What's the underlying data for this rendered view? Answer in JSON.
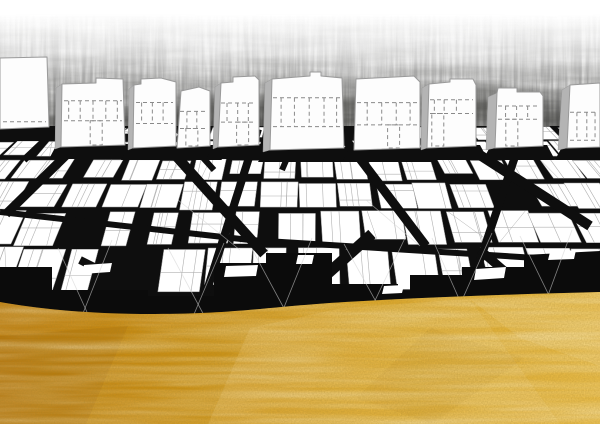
{
  "canvas": {
    "width": 600,
    "height": 424
  },
  "colors": {
    "paper": "#ffffff",
    "map_black": "#0e0e0e",
    "band_black": "#0b0b0b",
    "block_white": "#ffffff",
    "block_stroke": "#979797",
    "parcel_line": "#b0b0b0",
    "building_fill": "#fdfdfd",
    "building_stroke": "#9a9a9a",
    "building_side": "#b4b4b4",
    "dash_line": "#8a8a8a",
    "ray": "#d2d2d2",
    "charcoal": "#2e2e2c",
    "charcoal_wash": "#9b9b98",
    "gold_dark": "#bf7e0e",
    "gold_light": "#eabd4a"
  },
  "charcoal": {
    "band_top": 14,
    "band_height": 136,
    "blotches": [
      [
        255,
        116,
        115,
        22,
        0.55
      ],
      [
        470,
        104,
        75,
        20,
        0.5
      ],
      [
        120,
        124,
        85,
        15,
        0.35
      ],
      [
        340,
        96,
        60,
        16,
        0.4
      ],
      [
        560,
        120,
        60,
        16,
        0.45
      ]
    ]
  },
  "buildings": [
    {
      "front": [
        [
          0,
          58
        ],
        [
          47,
          57
        ],
        [
          49,
          127
        ],
        [
          0,
          129
        ]
      ],
      "levels": [
        0.9
      ],
      "mullions": [],
      "door": null
    },
    {
      "front": [
        [
          62,
          84
        ],
        [
          96,
          83
        ],
        [
          96,
          78
        ],
        [
          123,
          79
        ],
        [
          125,
          145
        ],
        [
          61,
          147
        ]
      ],
      "side": [
        [
          56,
          88
        ],
        [
          62,
          84
        ],
        [
          61,
          147
        ],
        [
          55,
          149
        ]
      ],
      "levels": [
        0.33,
        0.62
      ],
      "mullions": [
        0.12,
        0.3,
        0.5,
        0.7,
        0.88
      ],
      "door": 0.55
    },
    {
      "front": [
        [
          134,
          85
        ],
        [
          141,
          84
        ],
        [
          141,
          79
        ],
        [
          161,
          78
        ],
        [
          176,
          82
        ],
        [
          176,
          146
        ],
        [
          133,
          148
        ]
      ],
      "side": [
        [
          129,
          89
        ],
        [
          134,
          85
        ],
        [
          133,
          148
        ],
        [
          128,
          150
        ]
      ],
      "levels": [
        0.35,
        0.65
      ],
      "mullions": [
        0.2,
        0.45,
        0.7
      ],
      "door": null
    },
    {
      "front": [
        [
          181,
          91
        ],
        [
          199,
          87
        ],
        [
          210,
          91
        ],
        [
          210,
          146
        ],
        [
          177,
          148
        ]
      ],
      "levels": [
        0.4,
        0.68
      ],
      "mullions": [
        0.3,
        0.6
      ],
      "door": 0.45
    },
    {
      "front": [
        [
          221,
          83
        ],
        [
          233,
          82
        ],
        [
          233,
          77
        ],
        [
          255,
          76
        ],
        [
          259,
          80
        ],
        [
          259,
          145
        ],
        [
          218,
          147
        ]
      ],
      "side": [
        [
          215,
          87
        ],
        [
          221,
          83
        ],
        [
          218,
          147
        ],
        [
          213,
          149
        ]
      ],
      "levels": [
        0.38,
        0.65
      ],
      "mullions": [
        0.22,
        0.48,
        0.74
      ],
      "door": 0.6
    },
    {
      "front": [
        [
          272,
          79
        ],
        [
          310,
          76
        ],
        [
          310,
          72
        ],
        [
          321,
          72
        ],
        [
          321,
          76
        ],
        [
          342,
          78
        ],
        [
          344,
          148
        ],
        [
          270,
          150
        ]
      ],
      "side": [
        [
          265,
          83
        ],
        [
          272,
          79
        ],
        [
          270,
          150
        ],
        [
          263,
          152
        ]
      ],
      "levels": [
        0.33,
        0.7
      ],
      "mullions": [
        0.15,
        0.33,
        0.53,
        0.73,
        0.9
      ],
      "door": null
    },
    {
      "front": [
        [
          356,
          79
        ],
        [
          414,
          76
        ],
        [
          420,
          82
        ],
        [
          420,
          148
        ],
        [
          354,
          150
        ]
      ],
      "levels": [
        0.36,
        0.66
      ],
      "mullions": [
        0.2,
        0.42,
        0.64,
        0.85
      ],
      "door": 0.6
    },
    {
      "front": [
        [
          429,
          84
        ],
        [
          450,
          82
        ],
        [
          450,
          79
        ],
        [
          473,
          79
        ],
        [
          476,
          85
        ],
        [
          476,
          146
        ],
        [
          427,
          148
        ]
      ],
      "side": [
        [
          422,
          88
        ],
        [
          429,
          84
        ],
        [
          427,
          148
        ],
        [
          421,
          150
        ]
      ],
      "levels": [
        0.3,
        0.5
      ],
      "mullions": [
        0.15,
        0.35,
        0.6
      ],
      "door": 0.22
    },
    {
      "front": [
        [
          497,
          93
        ],
        [
          498,
          88
        ],
        [
          517,
          88
        ],
        [
          517,
          92
        ],
        [
          540,
          92
        ],
        [
          543,
          96
        ],
        [
          543,
          146
        ],
        [
          495,
          148
        ]
      ],
      "side": [
        [
          488,
          97
        ],
        [
          497,
          93
        ],
        [
          495,
          148
        ],
        [
          486,
          150
        ]
      ],
      "levels": [
        0.3,
        0.52
      ],
      "mullions": [
        0.22,
        0.45,
        0.68
      ],
      "door": 0.35
    },
    {
      "front": [
        [
          570,
          85
        ],
        [
          600,
          83
        ],
        [
          600,
          147
        ],
        [
          567,
          148
        ]
      ],
      "side": [
        [
          562,
          90
        ],
        [
          570,
          85
        ],
        [
          567,
          148
        ],
        [
          558,
          150
        ]
      ],
      "levels": [
        0.45,
        0.88
      ],
      "mullions": [
        0.3,
        0.6,
        0.85
      ],
      "door": null
    }
  ],
  "map": {
    "top": 126,
    "height": 178,
    "seed": 13,
    "skip": 0.06,
    "rows": [
      {
        "y": 128,
        "h": 14,
        "w": 30
      },
      {
        "y": 142,
        "h": 18,
        "w": 33
      },
      {
        "y": 160,
        "h": 23,
        "w": 36
      },
      {
        "y": 183,
        "h": 29,
        "w": 40
      },
      {
        "y": 212,
        "h": 36,
        "w": 44
      },
      {
        "y": 248,
        "h": 46,
        "w": 48
      }
    ],
    "streets": [
      [
        96,
        126,
        6,
        214,
        9
      ],
      [
        150,
        127,
        264,
        254,
        10
      ],
      [
        258,
        129,
        204,
        300,
        8
      ],
      [
        336,
        127,
        426,
        246,
        9
      ],
      [
        438,
        128,
        590,
        226,
        10
      ],
      [
        524,
        130,
        466,
        302,
        8
      ],
      [
        176,
        128,
        214,
        170,
        6
      ],
      [
        300,
        128,
        282,
        170,
        6
      ],
      [
        0,
        212,
        250,
        240,
        6
      ],
      [
        250,
        240,
        600,
        262,
        6
      ],
      [
        372,
        234,
        296,
        302,
        11
      ],
      [
        80,
        260,
        160,
        300,
        8
      ],
      [
        480,
        250,
        540,
        302,
        9
      ],
      [
        60,
        126,
        24,
        160,
        7
      ]
    ]
  },
  "band": {
    "path": "M0,267 L52,267 L52,290 L148,290 L148,296 L214,296 L214,263 L266,263 L266,253 L332,253 L332,284 L398,284 L398,291 L410,291 L410,275 L462,275 L462,267 L524,267 L524,255 L600,251 L600,318 L0,330 Z",
    "shards": [
      [
        [
          226,
          266
        ],
        [
          258,
          265
        ],
        [
          256,
          276
        ],
        [
          224,
          277
        ]
      ],
      [
        [
          298,
          255
        ],
        [
          314,
          255
        ],
        [
          312,
          264
        ],
        [
          296,
          264
        ]
      ],
      [
        [
          476,
          269
        ],
        [
          506,
          267
        ],
        [
          504,
          278
        ],
        [
          474,
          280
        ]
      ],
      [
        [
          84,
          265
        ],
        [
          112,
          263
        ],
        [
          110,
          272
        ],
        [
          82,
          274
        ]
      ],
      [
        [
          550,
          252
        ],
        [
          576,
          250
        ],
        [
          574,
          259
        ],
        [
          548,
          260
        ]
      ],
      [
        [
          384,
          286
        ],
        [
          404,
          285
        ],
        [
          402,
          293
        ],
        [
          382,
          294
        ]
      ]
    ]
  },
  "rays": [
    [
      58,
      248,
      96,
      332
    ],
    [
      112,
      240,
      74,
      336
    ],
    [
      168,
      248,
      214,
      334
    ],
    [
      224,
      243,
      184,
      338
    ],
    [
      252,
      249,
      300,
      338
    ],
    [
      312,
      238,
      270,
      342
    ],
    [
      344,
      244,
      394,
      334
    ],
    [
      406,
      236,
      356,
      340
    ],
    [
      432,
      238,
      472,
      328
    ],
    [
      492,
      233,
      446,
      336
    ],
    [
      520,
      236,
      562,
      322
    ],
    [
      572,
      230,
      536,
      328
    ],
    [
      178,
      200,
      240,
      250
    ],
    [
      366,
      200,
      420,
      246
    ]
  ],
  "gold": {
    "edge_path": "M0,302 C45,310 95,314 155,314 C235,314 265,307 345,302 C432,297 520,294 600,292 L600,424 L0,424 Z",
    "gradient": [
      {
        "offset": 0,
        "color": "#bf7e0e"
      },
      {
        "offset": 0.35,
        "color": "#cf9418"
      },
      {
        "offset": 0.6,
        "color": "#dda82b"
      },
      {
        "offset": 1,
        "color": "#eabd4a"
      }
    ],
    "facets": [
      {
        "points": [
          [
            250,
            328
          ],
          [
            342,
            308
          ],
          [
            302,
            424
          ],
          [
            208,
            424
          ]
        ],
        "fill": "#ffe9a8",
        "opacity": 0.16
      },
      {
        "points": [
          [
            342,
            308
          ],
          [
            470,
            299
          ],
          [
            560,
            424
          ],
          [
            302,
            424
          ]
        ],
        "fill": "#fff0c0",
        "opacity": 0.12
      },
      {
        "points": [
          [
            470,
            299
          ],
          [
            600,
            292
          ],
          [
            600,
            366
          ],
          [
            520,
            338
          ]
        ],
        "fill": "#fff2c8",
        "opacity": 0.15
      },
      {
        "points": [
          [
            0,
            336
          ],
          [
            128,
            326
          ],
          [
            86,
            424
          ],
          [
            0,
            424
          ]
        ],
        "fill": "#7a4c06",
        "opacity": 0.13
      },
      {
        "points": [
          [
            430,
            328
          ],
          [
            524,
            358
          ],
          [
            432,
            424
          ],
          [
            356,
            398
          ]
        ],
        "fill": "#a8730f",
        "opacity": 0.1
      },
      {
        "points": [
          [
            128,
            326
          ],
          [
            250,
            328
          ],
          [
            208,
            424
          ],
          [
            86,
            424
          ]
        ],
        "fill": "#c88f16",
        "opacity": 0.1
      }
    ]
  }
}
